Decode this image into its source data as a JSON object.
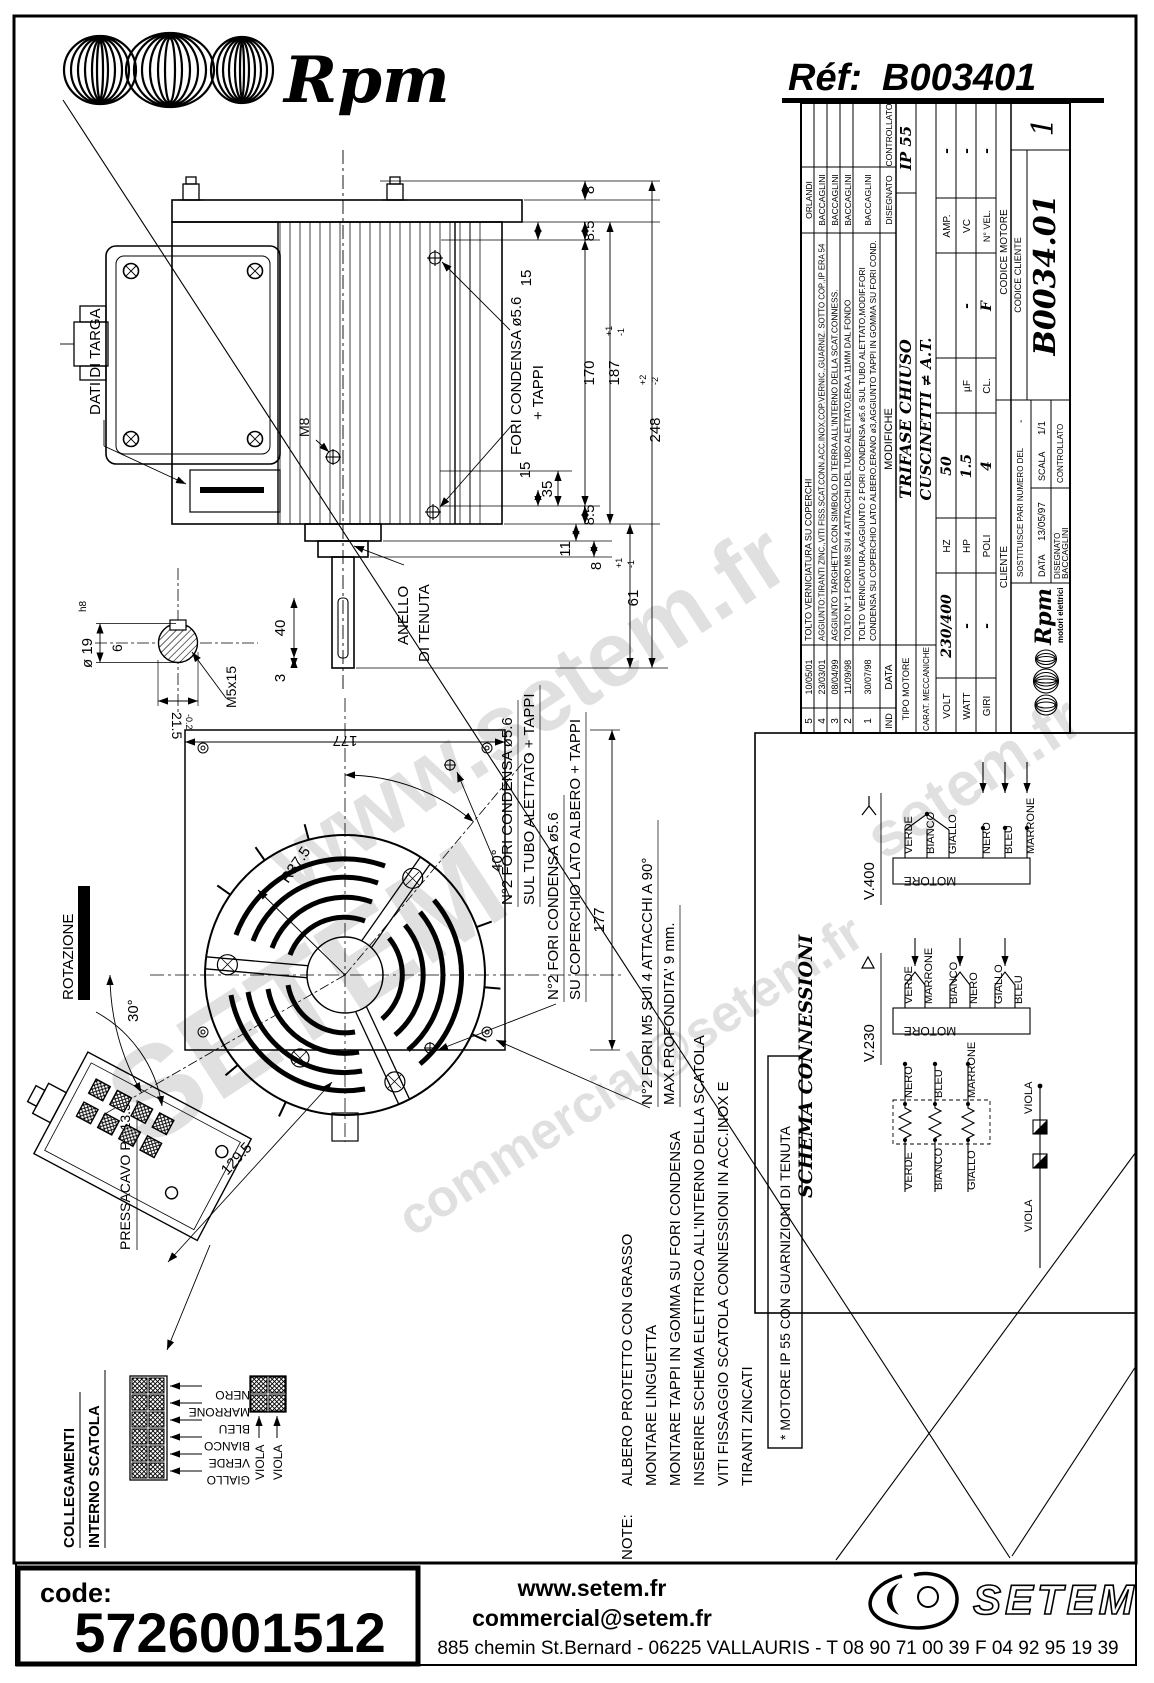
{
  "header": {
    "brand": "Rpm",
    "ref_label": "Réf:",
    "ref_value": "B003401"
  },
  "watermark": {
    "w1": "www.setem.fr",
    "w2": "SETEM",
    "w3": "commercial@setem.fr",
    "w4": "setem.fr"
  },
  "side_view": {
    "dati_targa": "DATI DI TARGA",
    "m8": "M8",
    "fori_label1": "FORI CONDENSA ø5.6",
    "fori_label2": "+ TAPPI",
    "anello1": "ANELLO",
    "anello2": "DI TENUTA",
    "dims": {
      "d8_top": "8",
      "d85_top": "8.5",
      "d15_top": "15",
      "d170": "170",
      "d187": "187",
      "d187p": "+1",
      "d187m": "-1",
      "d248": "248",
      "d248p": "+2",
      "d248m": "-2",
      "d35": "35",
      "d15_bot": "15",
      "d85_bot": "8.5",
      "d11": "11",
      "d8_bot": "8",
      "d61": "61",
      "d61p": "+1",
      "d61m": "-1",
      "d40": "40",
      "d3": "3"
    }
  },
  "shaft_detail": {
    "dia": "ø 19",
    "fit": "h8",
    "key_w": "6",
    "d215": "21.5",
    "d215t": "-0.2",
    "thread": "M5x15"
  },
  "front_view": {
    "d177_top": "177",
    "d177_right": "177",
    "r375": "R37.5",
    "a40": "40°",
    "a30": "30°",
    "d1295": "129.5",
    "rotazione": "ROTAZIONE",
    "pressacavo": "PRESSACAVO PG13.5",
    "lbl_tubo1": "N°2 FORI CONDENSA ø5.6",
    "lbl_tubo2": "SUL TUBO ALETTATO + TAPPI",
    "lbl_cop1": "N°2 FORI CONDENSA ø5.6",
    "lbl_cop2": "SU COPERCHIO LATO ALBERO + TAPPI",
    "lbl_m5_1": "N°2 FORI M5 SUI 4 ATTACCHI A 90°",
    "lbl_m5_2": "MAX.PROFONDITA' 9 mm."
  },
  "note": {
    "prefix": "NOTE:",
    "l1": "ALBERO PROTETTO CON GRASSO",
    "l2": "MONTARE LINGUETTA",
    "l3": "MONTARE TAPPI IN GOMMA SU FORI CONDENSA",
    "l4": "INSERIRE SCHEMA ELETTRICO ALL'INTERNO DELLA SCATOLA",
    "l5": "VITI FISSAGGIO SCATOLA CONNESSIONI IN ACC.INOX E",
    "l6": "TIRANTI ZINCATI"
  },
  "ip55_note": "* MOTORE IP 55 CON GUARNIZIONI DI TENUTA",
  "schema": {
    "title": "SCHEMA CONNESSIONI",
    "v400": "V.400",
    "v230": "V.230",
    "motore": "MOTORE",
    "s400": [
      "VERDE",
      "BIANCO",
      "GIALLO",
      "NERO",
      "BLEU",
      "MARRONE"
    ],
    "s230": [
      "VERDE",
      "MARRONE",
      "BIANCO",
      "NERO",
      "GIALLO",
      "BLEU"
    ],
    "wind_top": [
      "NERO",
      "BLEU",
      "MARRONE"
    ],
    "wind_bot": [
      "VERDE",
      "BIANCO",
      "GIALLO"
    ],
    "viola": "VIOLA"
  },
  "collegamenti": {
    "t1": "COLLEGAMENTI",
    "t2": "INTERNO SCATOLA",
    "wires": [
      "NERO",
      "MARRONE",
      "BLEU",
      "BIANCO",
      "VERDE",
      "GIALLO"
    ],
    "viola": "VIOLA"
  },
  "title_block": {
    "rev_cols": {
      "ind": "IND",
      "data": "DATA",
      "modifiche": "MODIFICHE",
      "disegnato": "DISEGNATO",
      "controllato": "CONTROLLATO"
    },
    "rev": [
      {
        "i": "5",
        "d": "10/05/01",
        "t": "TOLTO VERNICIATURA SU COPERCHI",
        "by": "ORLANDI"
      },
      {
        "i": "4",
        "d": "23/03/01",
        "t": "AGGIUNTO:TIRANTI ZINC.,VITI FISS.SCAT.CONN.ACC.INOX,COP.VERNIC.,GUARNIZ. SOTTO COP.,IP ERA 54",
        "by": "BACCAGLINI"
      },
      {
        "i": "3",
        "d": "08/04/99",
        "t": "AGGIUNTO TARGHETTA CON SIMBOLO DI TERRA ALL'INTERNO DELLA SCAT.CONNESS.",
        "by": "BACCAGLINI"
      },
      {
        "i": "2",
        "d": "11/09/98",
        "t": "TOLTO N° 1 FORO M8 SUI 4 ATTACCHI DEL TUBO ALETTATO,ERA A 11MM DAL FONDO",
        "by": "BACCAGLINI"
      },
      {
        "i": "1",
        "d": "30/07/98",
        "t1": "TOLTO VERNICIATURA,AGGIUNTO 2 FORI CONDENSA ø5.6 SUL TUBO ALETTATO,MODIF.FORI",
        "t2": "CONDENSA SU COPERCHIO LATO ALBERO,ERANO ø3,AGGIUNTO TAPPI IN GOMMA SU FORI COND.",
        "by": "BACCAGLINI"
      }
    ],
    "tipo_label": "TIPO MOTORE",
    "tipo": "TRIFASE CHIUSO",
    "ip": "IP 55",
    "carat_label": "CARAT. MECCANICHE",
    "carat": "CUSCINETTI ≠ A.T.",
    "volt_label": "VOLT",
    "volt": "230/400",
    "hz_label": "HZ",
    "hz": "50",
    "amp_label": "AMP.",
    "amp": "-",
    "watt_label": "WATT",
    "watt": "-",
    "hp_label": "HP",
    "hp": "1.5",
    "uf_label": "µF",
    "uf": "-",
    "vc_label": "VC",
    "vc": "-",
    "giri_label": "GIRI",
    "giri": "-",
    "poli_label": "POLI",
    "poli": "4",
    "cl_label": "CL.",
    "cl": "F",
    "nvel_label": "N° VEL.",
    "nvel": "-",
    "cliente": "CLIENTE",
    "codice_motore": "CODICE MOTORE",
    "codice_cliente": "CODICE CLIENTE",
    "logo_brand": "Rpm",
    "logo_sub": "motori elettrici",
    "sost": "SOSTITUISCE PARI NUMERO DEL",
    "sost_v": "-",
    "data_label": "DATA",
    "data_v": "13/05/97",
    "scala_label": "SCALA",
    "scala_v": "1/1",
    "disegnato_label": "DISEGNATO",
    "disegnato_v": "BACCAGLINI",
    "controllato_label": "CONTROLLATO",
    "codice": "B0034.01",
    "sheet": "1"
  },
  "footer": {
    "code_label": "code:",
    "code_value": "5726001512",
    "website": "www.setem.fr",
    "email": "commercial@setem.fr",
    "logo": "SETEM",
    "address": "885 chemin St.Bernard  -  06225 VALLAURIS  -  T 08 90 71 00 39   F 04 92 95 19 39"
  }
}
